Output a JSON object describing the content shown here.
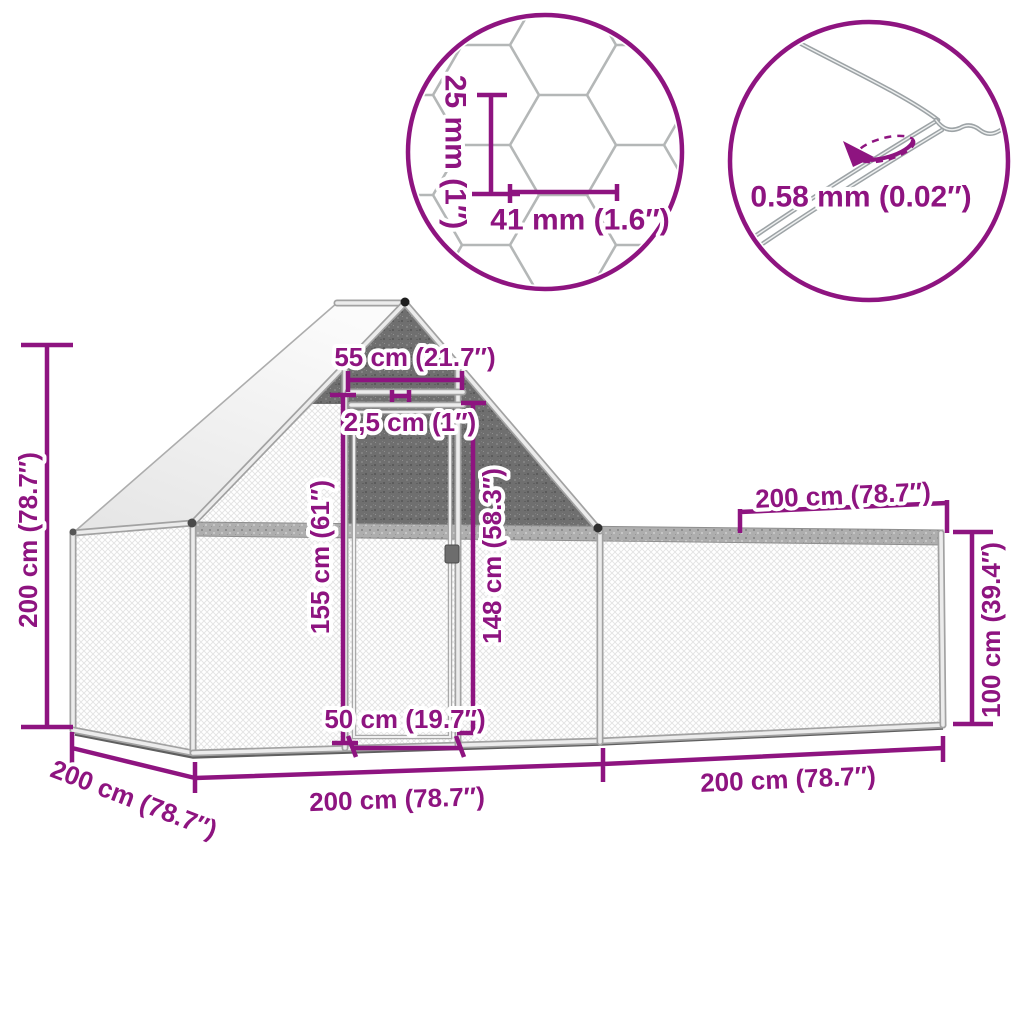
{
  "colors": {
    "accent": "#8E1480",
    "frame_silver": "#ececec",
    "frame_edge": "#a2a2a2",
    "mesh_light": "#e3e3e3",
    "mesh_dark": "#6f6f6f",
    "wire_gray": "#9da3a6",
    "roof_white": "#f4f4f4"
  },
  "callouts": {
    "mesh": {
      "height": "25 mm (1″)",
      "width": "41 mm (1.6″)"
    },
    "wire": {
      "thickness": "0.58 mm (0.02″)"
    }
  },
  "dimensions": {
    "ridge_width": "55 cm (21.7″)",
    "tube_thickness": "2,5 cm (1″)",
    "door_height": "155 cm (61″)",
    "frame_height": "148 cm (58.3″)",
    "door_width": "50 cm (19.7″)",
    "total_height": "200 cm (78.7″)",
    "depth": "200 cm (78.7″)",
    "left_section_length": "200 cm (78.7″)",
    "right_section_length": "200 cm (78.7″)",
    "run_top_length": "200 cm (78.7″)",
    "run_height": "100 cm (39.4″)"
  }
}
